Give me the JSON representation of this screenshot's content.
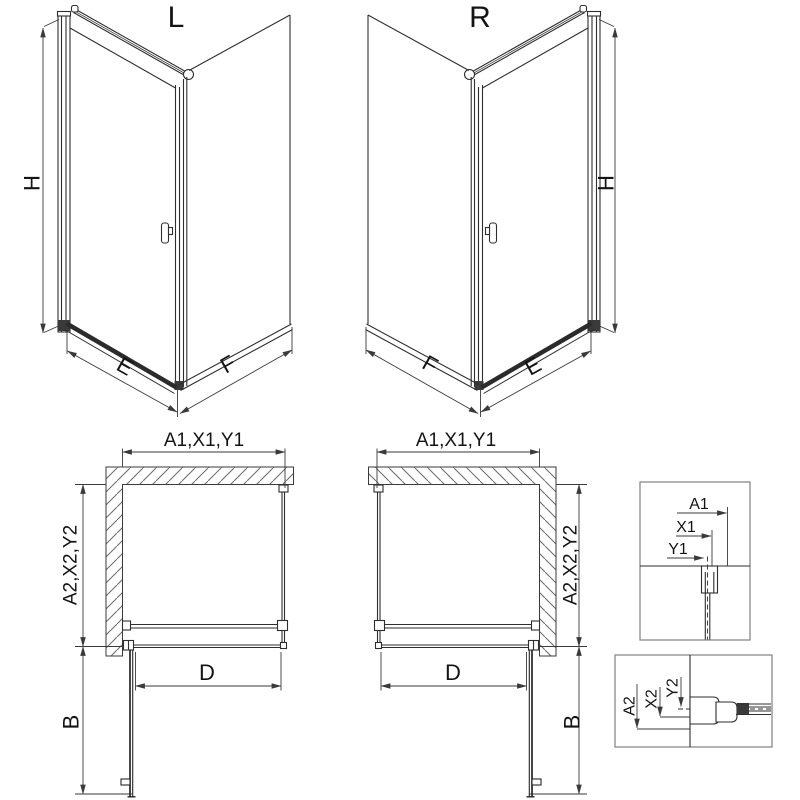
{
  "drawing": {
    "variants": {
      "left": {
        "label": "L"
      },
      "right": {
        "label": "R"
      }
    },
    "dimensions": {
      "height": "H",
      "door_side": "E",
      "panel_side": "F",
      "plan_top": "A1,X1,Y1",
      "plan_side": "A2,X2,Y2",
      "door_clear_width": "D",
      "door_open_depth": "B"
    },
    "details": {
      "horizontal": {
        "a": "A1",
        "x": "X1",
        "y": "Y1"
      },
      "vertical": {
        "a": "A2",
        "x": "X2",
        "y": "Y2"
      }
    },
    "colors": {
      "line": "#2e2e2e",
      "dim_line": "#3a3a3a",
      "hatch": "#6a6a6a",
      "box_border": "#8a8a8a",
      "text": "#141414",
      "background": "#ffffff"
    }
  }
}
